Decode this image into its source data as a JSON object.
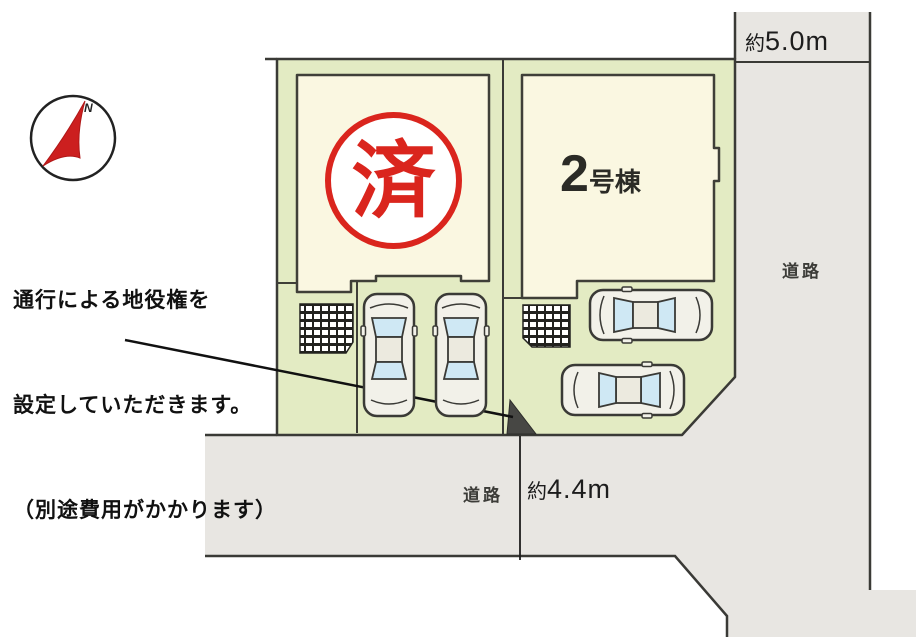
{
  "plan": {
    "annotation": {
      "line1": "通行による地役権を",
      "line2": "設定していただきます。",
      "line3": "（別途費用がかかります）"
    },
    "stamp_label": "済",
    "unit2": {
      "number": "2",
      "name": "号棟"
    },
    "road_right": {
      "label": "道路",
      "width_prefix": "約",
      "width_value": "5.0m"
    },
    "road_bottom": {
      "label": "道路",
      "width_prefix": "約",
      "width_value": "4.4m"
    },
    "compass_label": "N",
    "colors": {
      "plot_green": "#e3ebc3",
      "building_cream": "#faf7e1",
      "road_gray": "#e8e6e2",
      "outline": "#3a3a36",
      "stamp_red": "#da251d",
      "windshield_blue": "#cfe8f4"
    }
  }
}
